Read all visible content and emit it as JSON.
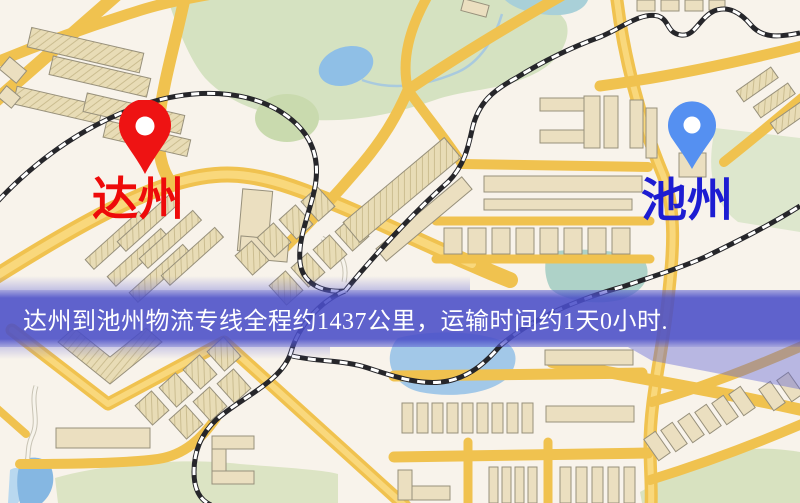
{
  "page": {
    "kind": "logistics-route-map",
    "width_px": 800,
    "height_px": 503
  },
  "banner": {
    "text": "达州到池州物流专线全程约1437公里，运输时间约1天0小时.",
    "background_color": "#4a4ec8",
    "text_color": "#ffffff",
    "distance_km": "1437",
    "transit_time": "1天0小时"
  },
  "markers": {
    "origin": {
      "label": "达州",
      "pin_color": "#ee1313",
      "label_color": "#ee0a0a"
    },
    "destination": {
      "label": "池州",
      "pin_color": "#5590f1",
      "label_color": "#1d1dd2"
    }
  },
  "map_palette": {
    "background": "#f8f3eb",
    "road": "#f0c24f",
    "building": "#ebdfc0",
    "park": "#d5e2c1",
    "water": "#8fbfe6",
    "railway": "#26262a"
  }
}
